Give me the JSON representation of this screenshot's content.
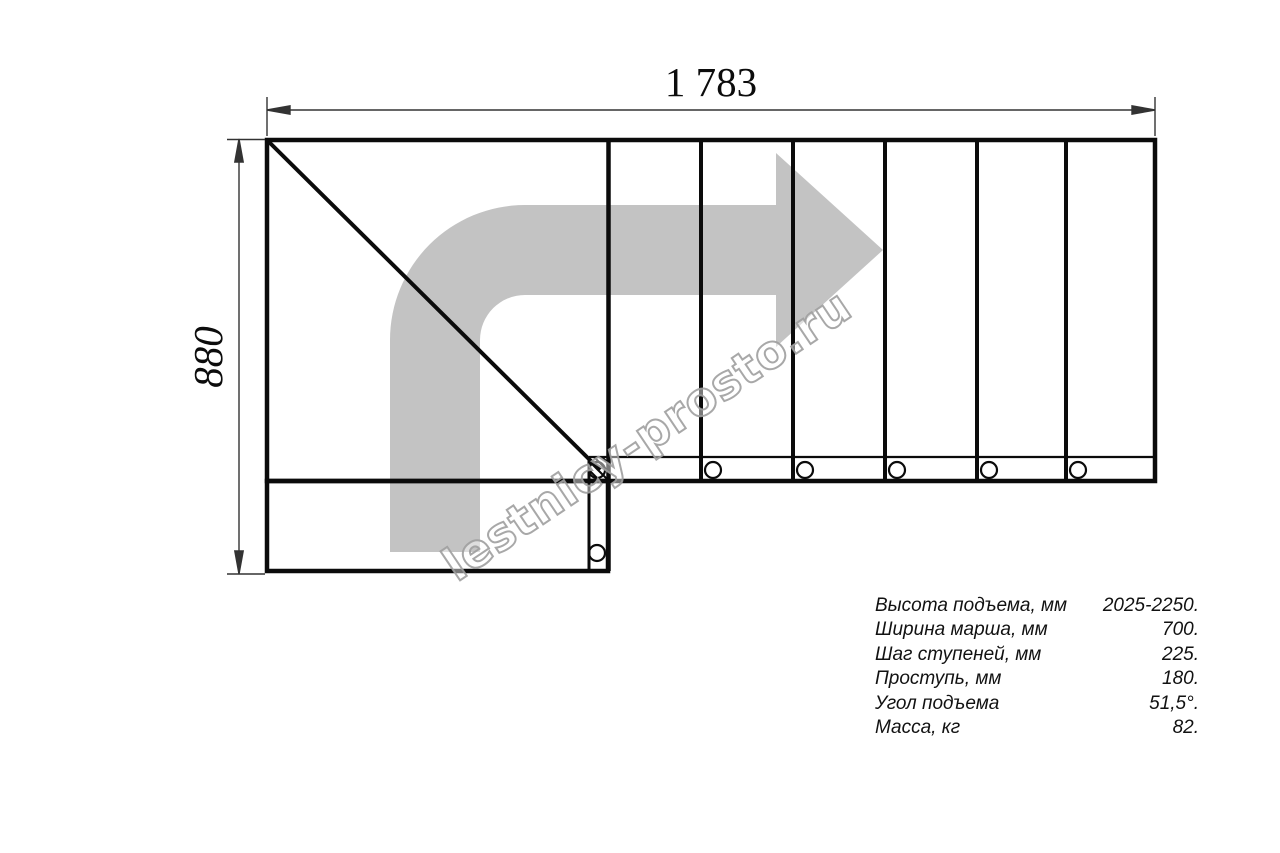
{
  "drawing": {
    "title": "staircase-plan-top-view",
    "dim_width_label": "1 783",
    "dim_height_label": "880",
    "watermark_text": "lestnicy-prosto.ru",
    "colors": {
      "line": "#0b0b0b",
      "dimension": "#333333",
      "arrow_fill": "#c3c3c3",
      "watermark_stroke": "#9e9e9e"
    }
  },
  "specs": {
    "rows": [
      {
        "label": "Высота подъема, мм",
        "value": "2025-2250."
      },
      {
        "label": "Ширина марша, мм",
        "value": "700."
      },
      {
        "label": "Шаг ступеней, мм",
        "value": "225."
      },
      {
        "label": "Проступь, мм",
        "value": "180."
      },
      {
        "label": "Угол подъема",
        "value": "51,5°."
      },
      {
        "label": "Масса, кг",
        "value": "82."
      }
    ]
  }
}
